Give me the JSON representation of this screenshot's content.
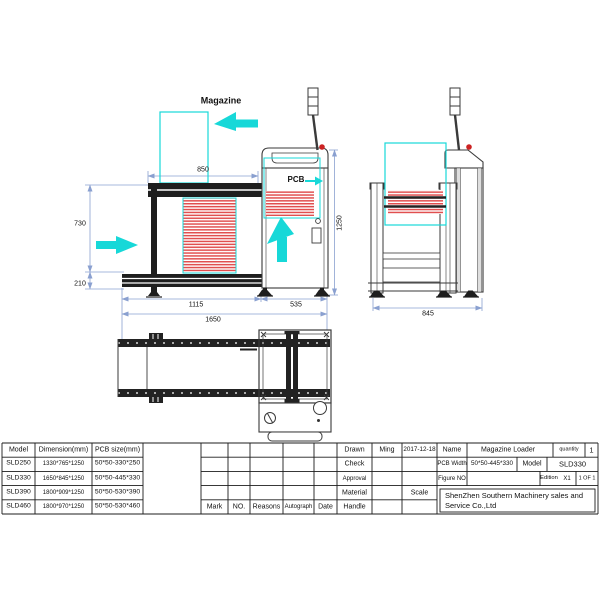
{
  "drawing": {
    "labels": {
      "magazine": "Magazine",
      "pcb": "PCB"
    },
    "dimensions": {
      "conveyor_length": "850",
      "conveyor_height": "730",
      "rail_height": "210",
      "frame_length": "1115",
      "cabinet_width": "535",
      "overall_length": "1650",
      "overall_height": "1250",
      "side_depth": "845"
    },
    "colors": {
      "highlight_cyan": "#17d8d8",
      "pcb_red": "#e14f4f",
      "dimension_blue": "#8aa0d0",
      "alert_red": "#cc2222"
    }
  },
  "model_table": {
    "headers": [
      "Model",
      "Dimension(mm)",
      "PCB size(mm)"
    ],
    "rows": [
      {
        "model": "SLD250",
        "dimension": "1330*765*1250",
        "pcb_size": "50*50-330*250"
      },
      {
        "model": "SLD330",
        "dimension": "1650*845*1250",
        "pcb_size": "50*50-445*330"
      },
      {
        "model": "SLD390",
        "dimension": "1800*909*1250",
        "pcb_size": "50*50-530*390"
      },
      {
        "model": "SLD460",
        "dimension": "1800*970*1250",
        "pcb_size": "50*50-530*460"
      }
    ]
  },
  "revision_table": {
    "headers": [
      "Mark",
      "NO.",
      "Reasons",
      "Autograph",
      "Date"
    ]
  },
  "title_block": {
    "drawn_label": "Drawn",
    "drawn_by": "Ming",
    "drawn_date": "2017-12-18",
    "check_label": "Check",
    "approval_label": "Approval",
    "material_label": "Material",
    "handle_label": "Handle",
    "scale_label": "Scale",
    "name_label": "Name",
    "name_value": "Magazine Loader",
    "quantity_label": "quantity",
    "quantity_value": "1",
    "pcb_width_label": "PCB Width",
    "pcb_width_value": "50*50-445*330",
    "model_label": "Model",
    "model_value": "SLD330",
    "figure_no_label": "Figure NO",
    "edition_label": "Edition",
    "edition_value": "X1",
    "page_value": "1 OF 1",
    "company": "ShenZhen Southern Machinery sales and Service Co.,Ltd"
  }
}
